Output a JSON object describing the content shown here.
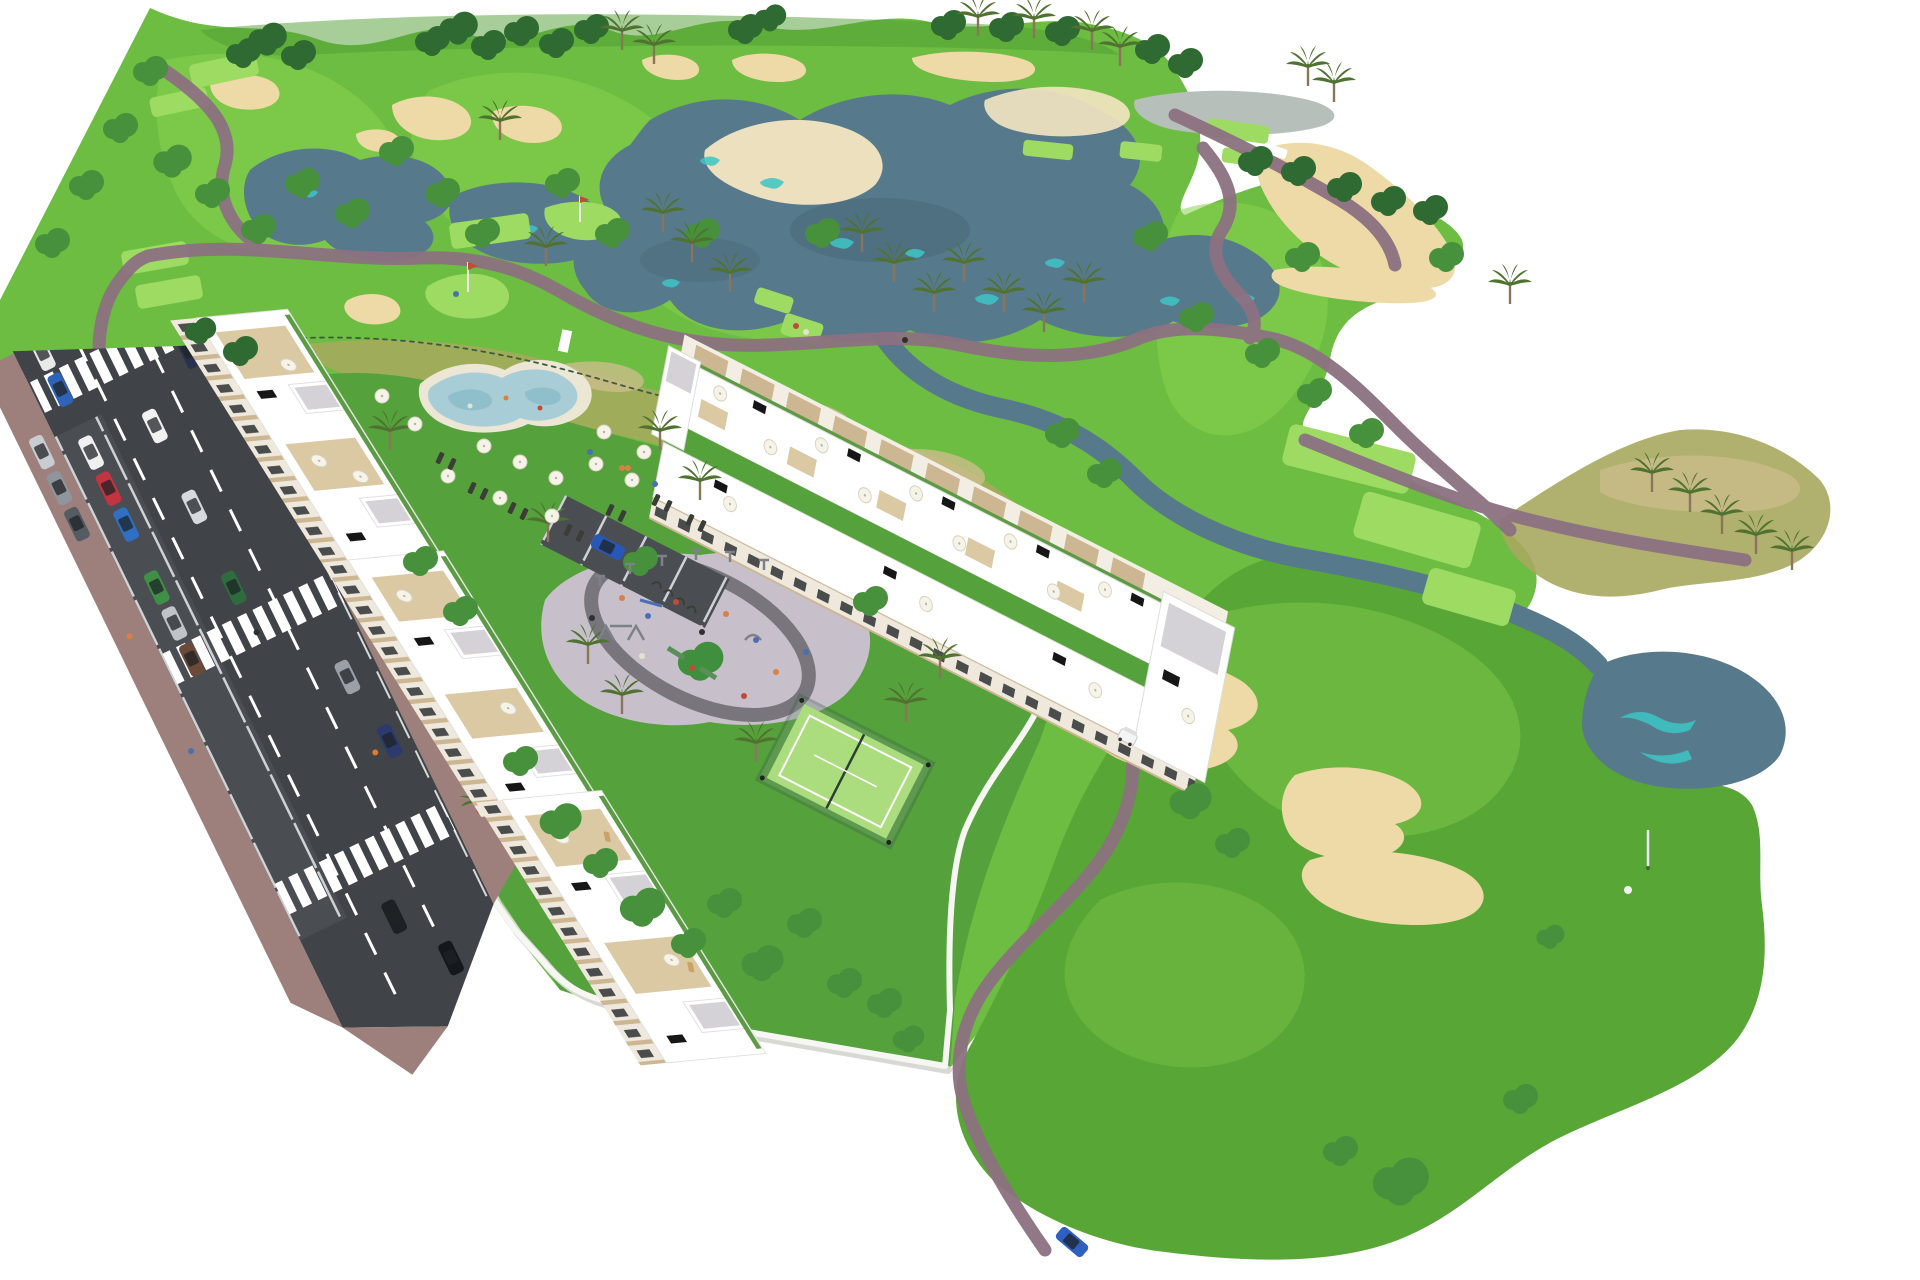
{
  "scene": {
    "description": "Aerial 3D architectural rendering of a golf resort residential development: white apartment blocks with roof terraces along a diagonal street with traffic, communal pool with sun loungers, playground plaza, padel court, and a golf course with lakes, sand bunkers, cart paths, palm trees and a putting green with golfer"
  },
  "palette": {
    "background": "#ffffff",
    "fairway": "#6cbd41",
    "fairwayLight": "#8ad24f",
    "fairwayPale": "#9ddb63",
    "roughDark": "#4f9d33",
    "lobeGreen": "#58a636",
    "lawnDark": "#55a13b",
    "scrubOlive": "#a8a95f",
    "scrubTan": "#cdbd8b",
    "lake": "#567a8b",
    "lakeDeep": "#49687a",
    "turquoise": "#3ec6c6",
    "pondGray": "#b7bfba",
    "sand": "#eedaa6",
    "sandLight": "#f4e6c2",
    "path": "#8c7181",
    "road": "#404448",
    "roadBay": "#4a4e52",
    "marking": "#ffffff",
    "sidewalk": "#9d807c",
    "wall": "#f6f6f3",
    "wallShadow": "#d9d9d4",
    "building": "#ffffff",
    "buildingShade": "#ececea",
    "facade": "#efe9dd",
    "accentBeige": "#cdb692",
    "deckBeige": "#dbc9a4",
    "roofGravel": "#d4d2d6",
    "windowDark": "#2e3134",
    "glass": "#bdd7d9",
    "panel": "#161616",
    "poolWater": "#a9cdd6",
    "poolDeep": "#8fbfcb",
    "poolDeck": "#ece6d4",
    "plaza": "#c7c0ca",
    "plazaRing": "#6f6d74",
    "padel": "#abdc7d",
    "padelFence": "#3e6047",
    "parkingLot": "#a5a3a8",
    "treeDark": "#2e6a31",
    "treeMid": "#47903c",
    "treeLight": "#71bd55",
    "palmFrond": "#4f7230",
    "trunk": "#8a755a",
    "fence": "#3a5d3f",
    "umbrella": "#f6f3e9",
    "lounger": "#3b3d39",
    "equipment": "#7d8288",
    "cart": "#f4f4f4",
    "flagPole": "#e8e8e8"
  },
  "cars": {
    "parking_row": [
      "#e9e9e9",
      "#2e63b8",
      "#c9ccd1",
      "#8f959c",
      "#555b63"
    ],
    "street_bays": [
      "#f0f0f0",
      "#c23540",
      "#2f6fc4",
      "#3f8f46",
      "#c0c3c8",
      "#6b4a3a"
    ],
    "driving": [
      "#f1f1f1",
      "#d6d9dd",
      "#2e6b3f",
      "#9aa0a6",
      "#28324e",
      "#1d2126",
      "#14171b"
    ],
    "parked_roadside": "#2c3a6e",
    "resort_parking": "#2857b8",
    "garden_south": "#2f5fbf"
  },
  "people_colors": [
    "#d9813f",
    "#4a6fb3",
    "#c14a39",
    "#2f2f2f",
    "#e8e0d0"
  ]
}
